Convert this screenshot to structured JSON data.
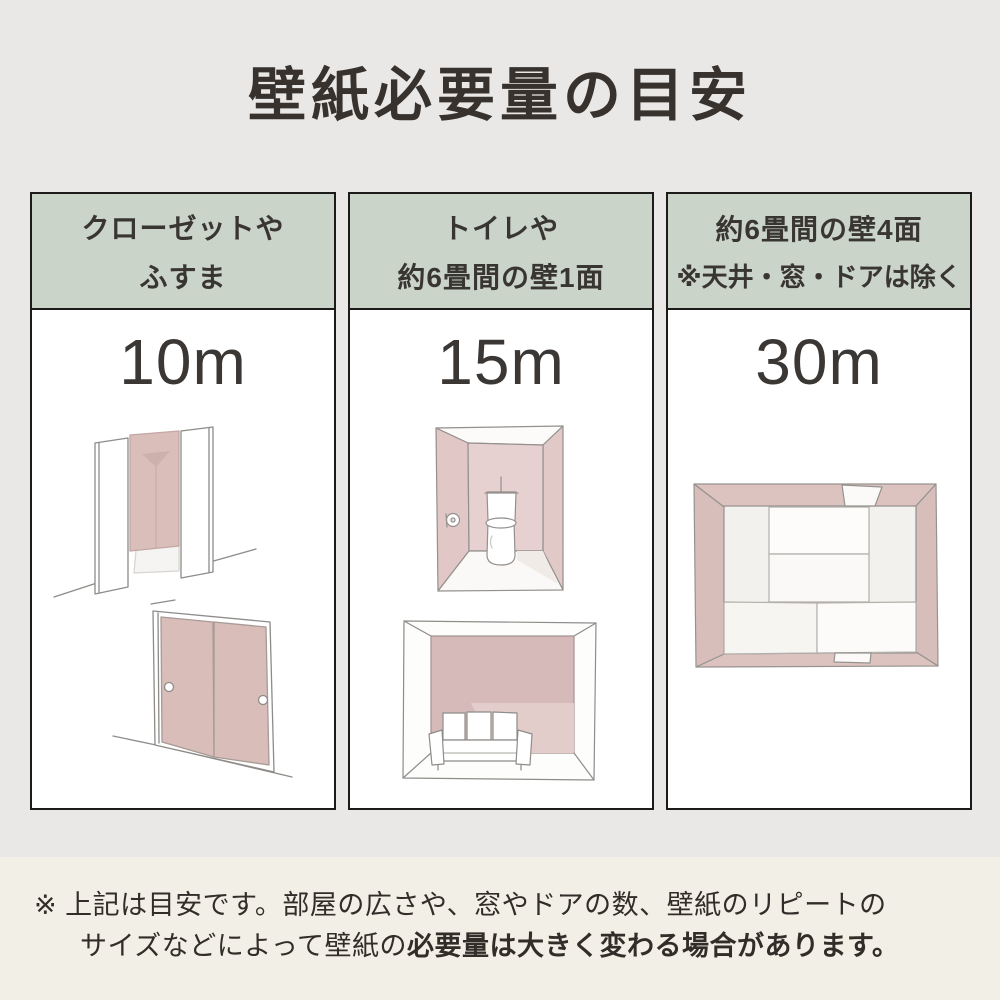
{
  "title": "壁紙必要量の目安",
  "columns": [
    {
      "header_line1": "クローゼットや",
      "header_line2": "ふすま",
      "amount": "10m"
    },
    {
      "header_line1": "トイレや",
      "header_line2": "約6畳間の壁1面",
      "amount": "15m"
    },
    {
      "header_line1": "約6畳間の壁4面",
      "header_line2": "※天井・窓・ドアは除く",
      "amount": "30m"
    }
  ],
  "note": {
    "line1": "※ 上記は目安です。部屋の広さや、窓やドアの数、壁紙のリピートの",
    "line2_normal": "サイズなどによって壁紙の",
    "line2_bold": "必要量は大きく変わる場合があります。"
  },
  "colors": {
    "page_background": "#e9e8e7",
    "note_background": "#f2efe6",
    "header_green": "#cbd4c8",
    "wall_pink": "#d8bdb8",
    "wall_pink_light": "#e7d1d0",
    "column_border": "#1d1b1a",
    "text_dark": "#37322e"
  }
}
